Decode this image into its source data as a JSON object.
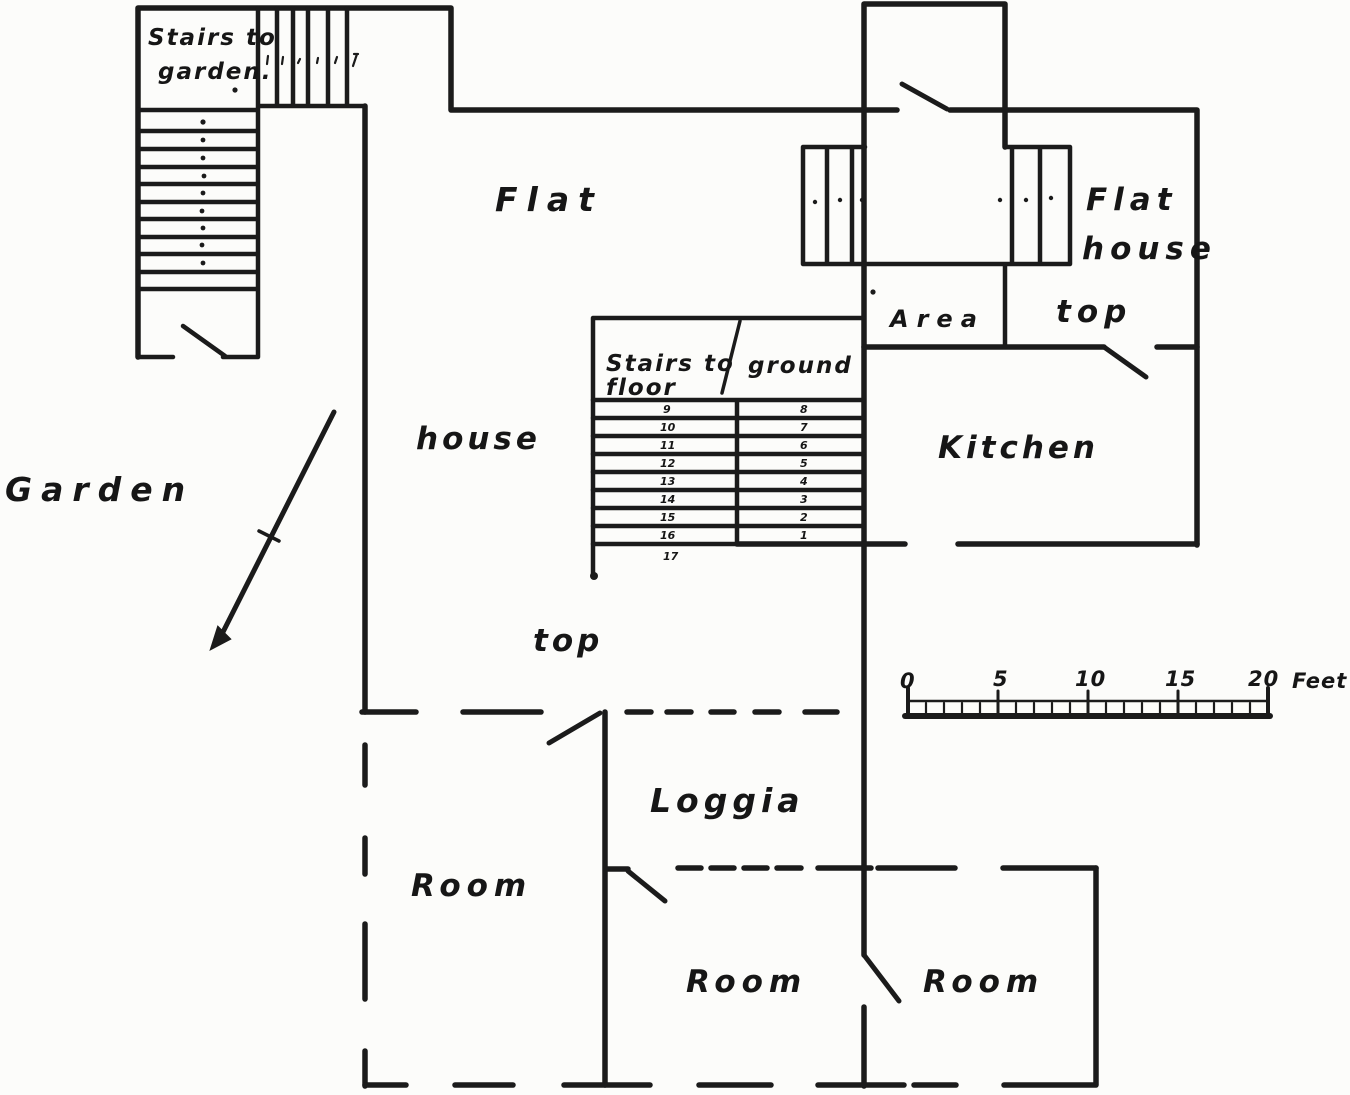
{
  "plan": {
    "labels": {
      "stairs_to_garden_line1": "Stairs to",
      "stairs_to_garden_line2": "garden.",
      "flat_center": "Flat",
      "flat_right_line1": "Flat",
      "flat_right_line2": "house",
      "flat_right_line3": "top",
      "area": "Area",
      "kitchen": "Kitchen",
      "stairs_ground_line1": "Stairs to",
      "stairs_ground_line2": "floor",
      "stairs_ground_word_right": "ground",
      "garden": "Garden",
      "house_center_line1": "house",
      "house_center_line2": "top",
      "loggia": "Loggia",
      "room_left": "Room",
      "room_center": "Room",
      "room_right": "Room"
    },
    "ground_stairs_numbers": {
      "left_column": [
        "9",
        "10",
        "11",
        "12",
        "13",
        "14",
        "15",
        "16"
      ],
      "left_bottom": "17",
      "right_column": [
        "8",
        "7",
        "6",
        "5",
        "4",
        "3",
        "2",
        "1"
      ]
    },
    "scale_bar": {
      "ticks": [
        "0",
        "5",
        "10",
        "15",
        "20"
      ],
      "unit": "Feet"
    },
    "ink_color": "#1b1b1b",
    "paper_color": "#fcfcfa"
  }
}
